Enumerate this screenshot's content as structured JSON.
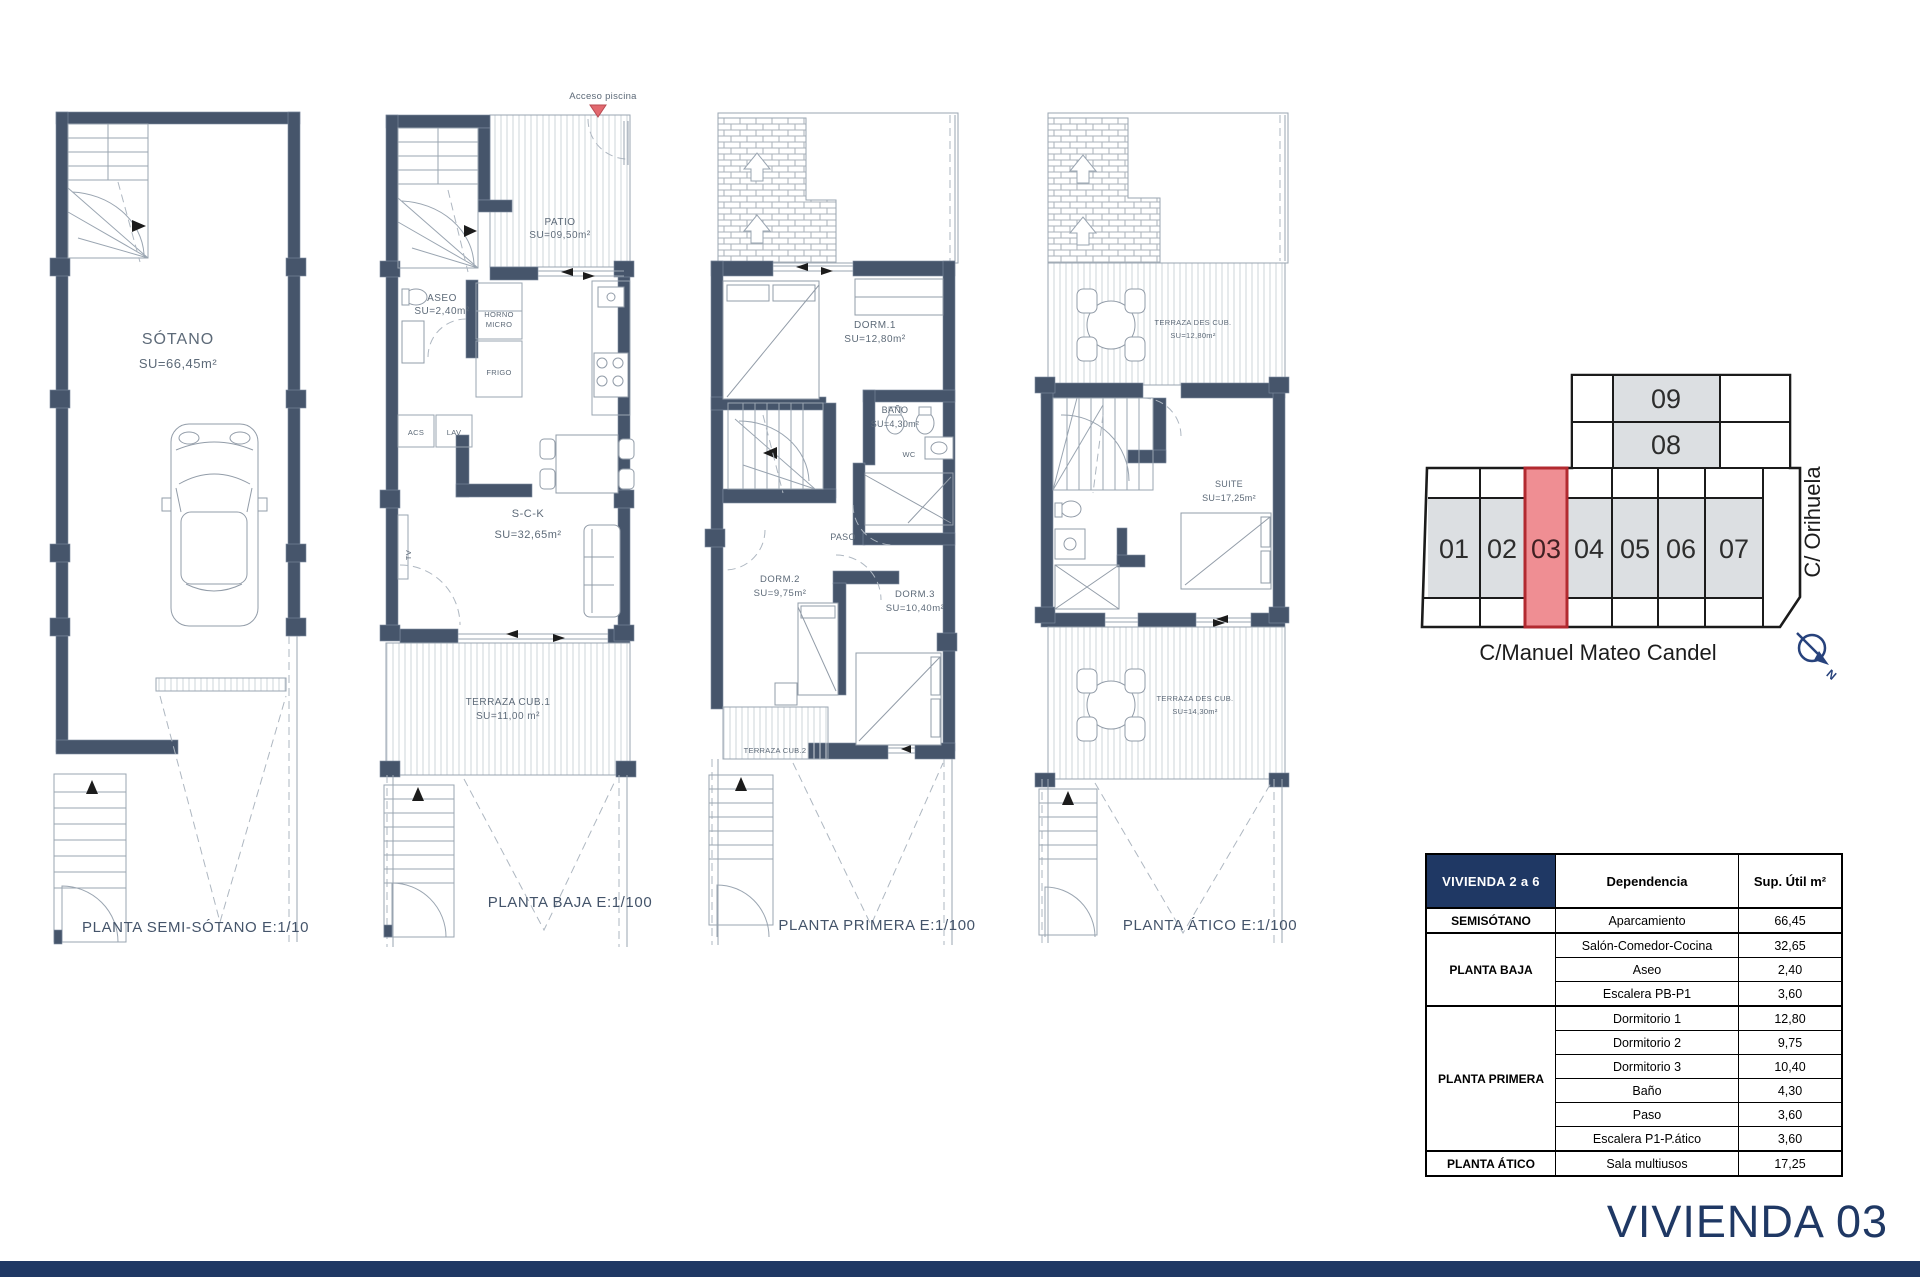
{
  "page": {
    "title": "VIVIENDA 03"
  },
  "colors": {
    "navy": "#1f3864",
    "wall": "#46556b",
    "unit_highlight_fill": "#ef8e93",
    "unit_highlight_border": "#b22a30",
    "unit_fill": "#dcdfe2",
    "marker_red": "#e2696f"
  },
  "plans": {
    "p1": {
      "caption": "PLANTA SEMI-SÓTANO  E:1/100",
      "room": "SÓTANO",
      "room_area": "SU=66,45m²"
    },
    "p2": {
      "caption": "PLANTA BAJA  E:1/100",
      "acceso": "Acceso piscina",
      "patio": "PATIO",
      "patio_area": "SU=09,50m²",
      "aseo": "ASEO",
      "aseo_area": "SU=2,40m²",
      "horno": "HORNO",
      "micro": "MICRO",
      "frigo": "FRIGO",
      "acs": "ACS",
      "lav": "LAV",
      "tv": "TV",
      "sck": "S-C-K",
      "sck_area": "SU=32,65m²",
      "terraza": "TERRAZA CUB.1",
      "terraza_area": "SU=11,00 m²"
    },
    "p3": {
      "caption": "PLANTA PRIMERA  E:1/100",
      "dorm1": "DORM.1",
      "dorm1_area": "SU=12,80m²",
      "wc": "WC",
      "bano": "BAÑO",
      "bano_area": "SU=4,30m²",
      "paso": "PASO",
      "dorm2": "DORM.2",
      "dorm2_area": "SU=9,75m²",
      "dorm3": "DORM.3",
      "dorm3_area": "SU=10,40m²",
      "terraza2": "TERRAZA CUB.2"
    },
    "p4": {
      "caption": "PLANTA ÁTICO  E:1/100",
      "terraza_sup": "TERRAZA DES CUB.",
      "terraza_sup_area": "SU=12,80m²",
      "suite": "SUITE",
      "suite_area": "SU=17,25m²",
      "terraza_inf": "TERRAZA DES CUB.",
      "terraza_inf_area": "SU=14,30m²"
    }
  },
  "site": {
    "top_units": [
      "09",
      "08"
    ],
    "units": [
      "01",
      "02",
      "03",
      "04",
      "05",
      "06",
      "07"
    ],
    "highlighted_unit": "03",
    "street_right": "C/ Orihuela",
    "street_bottom": "C/Manuel Mateo Candel",
    "north_label": "N"
  },
  "table": {
    "header": {
      "unit": "VIVIENDA 2 a 6",
      "room": "Dependencia",
      "area": "Sup. Útil m²"
    },
    "groups": [
      {
        "name": "SEMISÓTANO",
        "rooms": [
          {
            "label": "Aparcamiento",
            "area": "66,45"
          }
        ]
      },
      {
        "name": "PLANTA BAJA",
        "rooms": [
          {
            "label": "Salón-Comedor-Cocina",
            "area": "32,65"
          },
          {
            "label": "Aseo",
            "area": "2,40"
          },
          {
            "label": "Escalera PB-P1",
            "area": "3,60"
          }
        ]
      },
      {
        "name": "PLANTA PRIMERA",
        "rooms": [
          {
            "label": "Dormitorio 1",
            "area": "12,80"
          },
          {
            "label": "Dormitorio 2",
            "area": "9,75"
          },
          {
            "label": "Dormitorio 3",
            "area": "10,40"
          },
          {
            "label": "Baño",
            "area": "4,30"
          },
          {
            "label": "Paso",
            "area": "3,60"
          },
          {
            "label": "Escalera P1-P.ático",
            "area": "3,60"
          }
        ]
      },
      {
        "name": "PLANTA ÁTICO",
        "rooms": [
          {
            "label": "Sala multiusos",
            "area": "17,25"
          }
        ]
      }
    ]
  }
}
